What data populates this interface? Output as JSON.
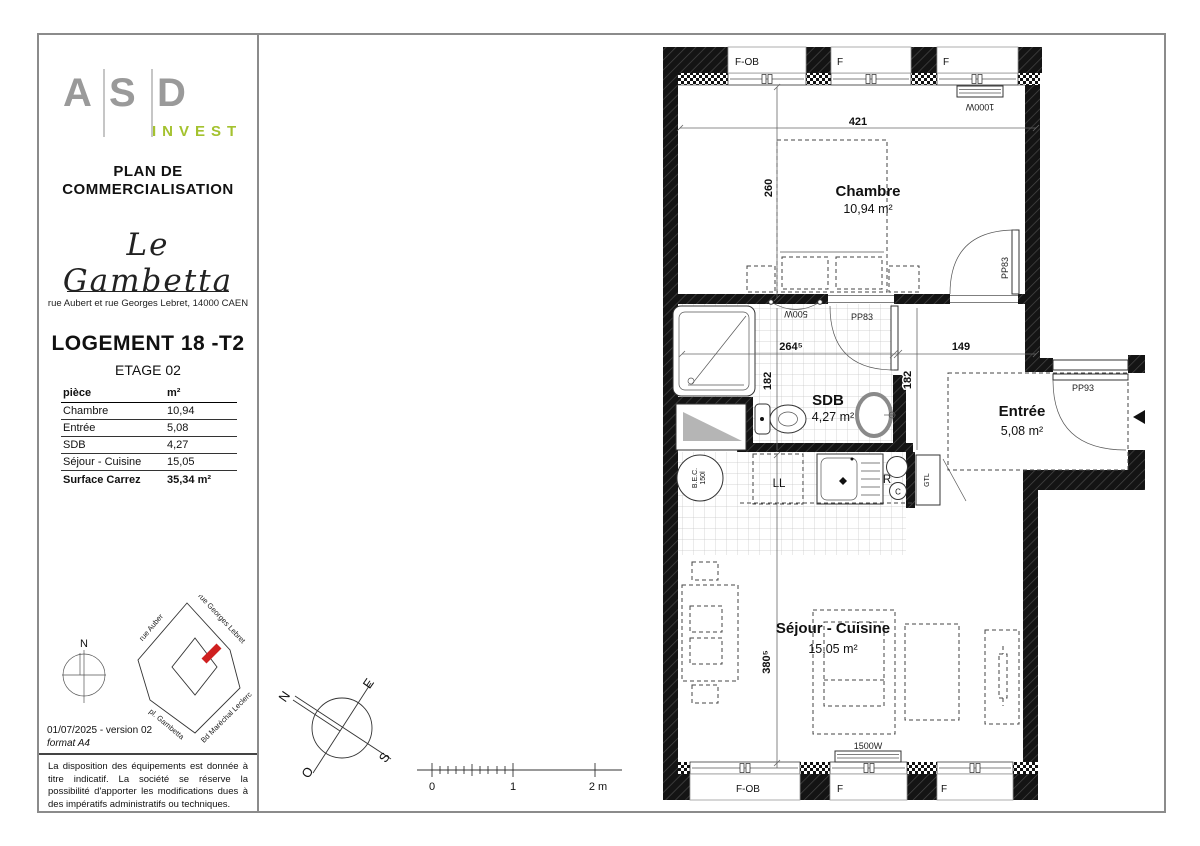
{
  "document": {
    "title_line1": "PLAN DE",
    "title_line2": "COMMERCIALISATION"
  },
  "sidebar": {
    "logo": {
      "l1": "A",
      "l2": "S",
      "l3": "D",
      "sub": "INVEST",
      "letter_color": "#9a9a9a",
      "invest_color": "#a4c22f"
    },
    "residence": "Le Gambetta",
    "address": "rue Aubert et rue Georges Lebret, 14000 CAEN",
    "unit": "LOGEMENT 18 -T2",
    "floor": "ETAGE 02",
    "table": {
      "col1": "pièce",
      "col2": "m²",
      "rows": [
        {
          "room": "Chambre",
          "area": "10,94"
        },
        {
          "room": "Entrée",
          "area": "5,08"
        },
        {
          "room": "SDB",
          "area": "4,27"
        },
        {
          "room": "Séjour - Cuisine",
          "area": "15,05"
        }
      ],
      "total_label": "Surface Carrez",
      "total_value": "35,34 m²"
    },
    "mini_compass_n": "N",
    "map_streets": {
      "s1": "rue Auber",
      "s2": "rue Georges Lebret",
      "s3": "pl. Gambetta",
      "s4": "Bd Maréchal Leclerc"
    },
    "map_marker_color": "#cf2020",
    "version": "01/07/2025 - version 02",
    "format": "format A4",
    "disclaimer": "La disposition des équipements est donnée à titre indicatif. La société se réserve la possibilité d'apporter les modifications dues à des impératifs administratifs ou techniques."
  },
  "plan": {
    "rooms": {
      "chambre": {
        "name": "Chambre",
        "area": "10,94 m²"
      },
      "sdb": {
        "name": "SDB",
        "area": "4,27 m²"
      },
      "entree": {
        "name": "Entrée",
        "area": "5,08 m²"
      },
      "sejour": {
        "name": "Séjour - Cuisine",
        "area": "15,05 m²"
      }
    },
    "windows_top": [
      "F-OB",
      "F",
      "F"
    ],
    "windows_bottom": [
      "F-OB",
      "F",
      "F"
    ],
    "doors": {
      "chambre": "PP83",
      "sdb": "PP83",
      "entry": "PP93"
    },
    "radiators": {
      "chambre": "1000W",
      "sdb": "500W",
      "sejour": "1500W"
    },
    "dims": {
      "top_width": "421",
      "chambre_depth": "260",
      "sdb_width": "264⁵",
      "sdb_height": "182",
      "hall_height": "182",
      "hall_width": "149",
      "sejour_depth": "380⁵"
    },
    "equipment": {
      "bec1": "B.E.C.",
      "bec2": "150l",
      "washer": "LL",
      "fridge": "R",
      "cooktop": "C",
      "gtl": "GTL"
    }
  },
  "compass": {
    "n": "N",
    "e": "E",
    "s": "S",
    "o": "O"
  },
  "scalebar": {
    "t0": "0",
    "t1": "1",
    "t2": "2 m"
  }
}
